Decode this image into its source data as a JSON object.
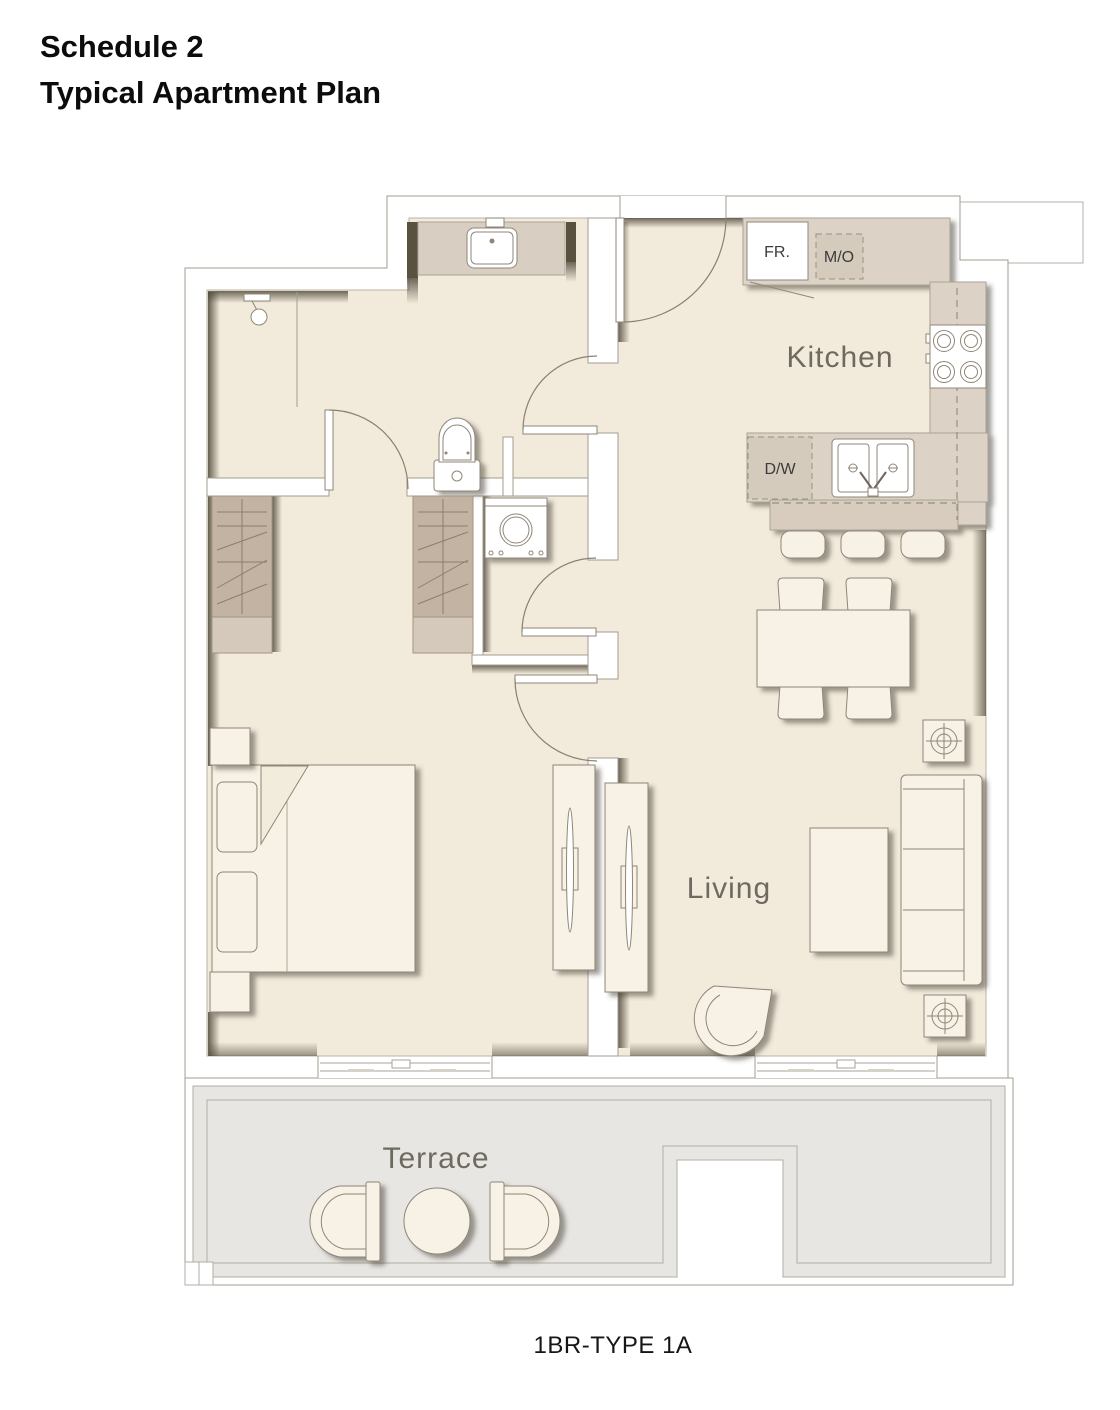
{
  "header": {
    "title_line1": "Schedule 2",
    "title_line2": "Typical Apartment Plan"
  },
  "footer": {
    "plan_type_label": "1BR-TYPE 1A"
  },
  "plan": {
    "room_labels": {
      "kitchen": "Kitchen",
      "living": "Living",
      "terrace": "Terrace"
    },
    "appliance_labels": {
      "fridge": "FR.",
      "microwave_oven": "M/O",
      "dishwasher": "D/W"
    },
    "fixture_icons": [
      "shower-icon",
      "toilet-icon",
      "vanity-sink-icon",
      "washing-machine-icon",
      "stove-icon",
      "kitchen-sink-icon",
      "wardrobe-icon",
      "bed",
      "sofa",
      "dining-table",
      "coffee-table",
      "lounge-chair",
      "side-table",
      "terrace-chair",
      "terrace-table",
      "tv-console",
      "door-swing"
    ],
    "colors": {
      "floor": "#f2ebdc",
      "counter": "#dcd3c6",
      "island": "#d7ccbe",
      "wardrobe_dark": "#c3b3a2",
      "wardrobe_light": "#d4c9bb",
      "terrace_floor": "#e7e6e3",
      "furniture": "#f7f2e5",
      "wall_line": "#a39d92",
      "shadow": "#4c4536",
      "label_text": "#6f6a60",
      "title_text": "#0c0c0c"
    }
  }
}
